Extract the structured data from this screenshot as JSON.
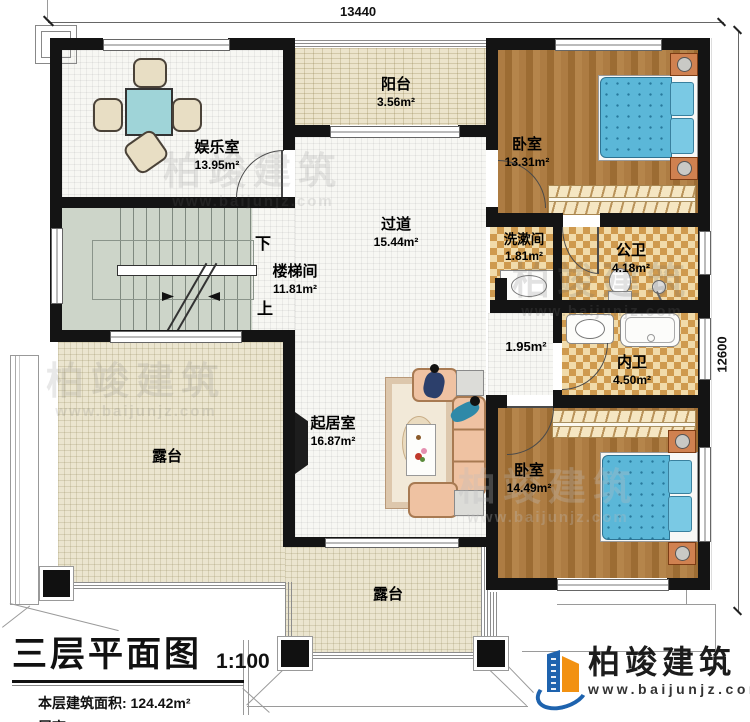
{
  "dimensions": {
    "top": "13440",
    "right": "12600"
  },
  "rooms": {
    "entertainment": {
      "name": "娱乐室",
      "area": "13.95m²"
    },
    "balcony": {
      "name": "阳台",
      "area": "3.56m²"
    },
    "bedroom1": {
      "name": "卧室",
      "area": "13.31m²"
    },
    "corridor": {
      "name": "过道",
      "area": "15.44m²"
    },
    "stairwell": {
      "name": "楼梯间",
      "area": "11.81m²"
    },
    "washroom": {
      "name": "洗漱间",
      "area": "1.81m²"
    },
    "public_bath": {
      "name": "公卫",
      "area": "4.18m²"
    },
    "hallway": {
      "area": "1.95m²"
    },
    "private_bath": {
      "name": "内卫",
      "area": "4.50m²"
    },
    "living": {
      "name": "起居室",
      "area": "16.87m²"
    },
    "bedroom2": {
      "name": "卧室",
      "area": "14.49m²"
    },
    "terrace_left": {
      "name": "露台"
    },
    "terrace_bottom": {
      "name": "露台"
    }
  },
  "stairs": {
    "down": "下",
    "up": "上"
  },
  "title_block": {
    "title": "三层平面图",
    "scale": "1:100",
    "floor_area": "本层建筑面积: 124.42m²",
    "floor_height": "层高: 3.3m"
  },
  "brand": {
    "name": "柏竣建筑",
    "site": "www.baijunjz.com"
  },
  "watermark": {
    "name": "柏竣建筑",
    "site": "www.baijunjz.com"
  },
  "colors": {
    "wall": "#141414",
    "bed": "#5bb7d8",
    "wood": "#a87a42",
    "bath_checker": "#cf9a4e",
    "terrace": "#ebe5cf",
    "stair": "#cdd5c9",
    "brand_blue": "#1e63ae",
    "brand_orange": "#f29111"
  }
}
